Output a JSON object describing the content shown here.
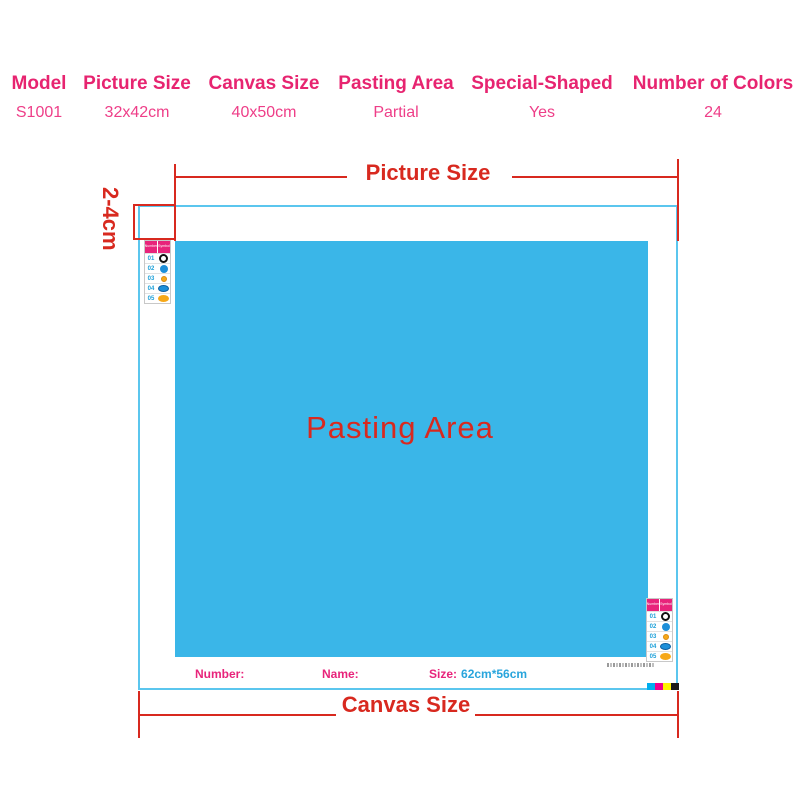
{
  "spec_table": {
    "columns": [
      {
        "label": "Model",
        "value": "S1001"
      },
      {
        "label": "Picture Size",
        "value": "32x42cm"
      },
      {
        "label": "Canvas Size",
        "value": "40x50cm"
      },
      {
        "label": "Pasting Area",
        "value": "Partial"
      },
      {
        "label": "Special-Shaped",
        "value": "Yes"
      },
      {
        "label": "Number of Colors",
        "value": "24"
      }
    ]
  },
  "diagram": {
    "picture_size_label": "Picture Size",
    "canvas_size_label": "Canvas Size",
    "pasting_area_label": "Pasting Area",
    "margin_label": "2-4cm",
    "footer": {
      "number_label": "Number:",
      "name_label": "Name:",
      "size_label": "Size:",
      "size_value": "62cm*56cm"
    }
  },
  "legend": {
    "header": {
      "col1": "Number",
      "col2": "Symbol"
    },
    "rows": [
      {
        "num": "01",
        "symbol": "black-donut"
      },
      {
        "num": "02",
        "symbol": "blue-circle"
      },
      {
        "num": "03",
        "symbol": "yellow-circle"
      },
      {
        "num": "04",
        "symbol": "blue-oval"
      },
      {
        "num": "05",
        "symbol": "orange-oval"
      }
    ]
  },
  "colors": {
    "pink_heading": "#e72470",
    "pink_value": "#ee3e88",
    "red_annotation": "#d8291f",
    "pasting_blue": "#3ab6e8",
    "canvas_border_cyan": "#5bc6ee",
    "legend_number_blue": "#1b9fd8",
    "size_value_blue": "#29a5dc",
    "cmyk_bar": [
      "#00aeef",
      "#ec008c",
      "#fff200",
      "#1a1a1a"
    ]
  }
}
